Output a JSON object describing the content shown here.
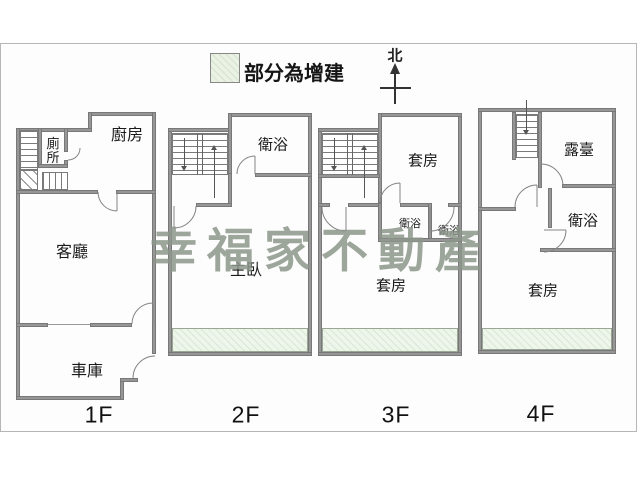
{
  "legend": {
    "label": "部分為增建",
    "swatch_color": "#eaf2e4"
  },
  "compass": {
    "label": "北"
  },
  "watermark": {
    "text": "幸福家不動產",
    "color": "#8d978b"
  },
  "colors": {
    "wall": "#969696",
    "addition_fill": "#eef5ea"
  },
  "floors": [
    {
      "label": "1F",
      "rooms": {
        "toilet": "廁所",
        "kitchen": "廚房",
        "living": "客廳",
        "garage": "車庫"
      }
    },
    {
      "label": "2F",
      "rooms": {
        "bath": "衛浴",
        "master": "主臥"
      }
    },
    {
      "label": "3F",
      "rooms": {
        "suite_top": "套房",
        "bath1": "衛浴",
        "bath2": "衛浴",
        "suite_bottom": "套房"
      }
    },
    {
      "label": "4F",
      "rooms": {
        "terrace": "露臺",
        "bath": "衛浴",
        "suite": "套房"
      }
    }
  ]
}
